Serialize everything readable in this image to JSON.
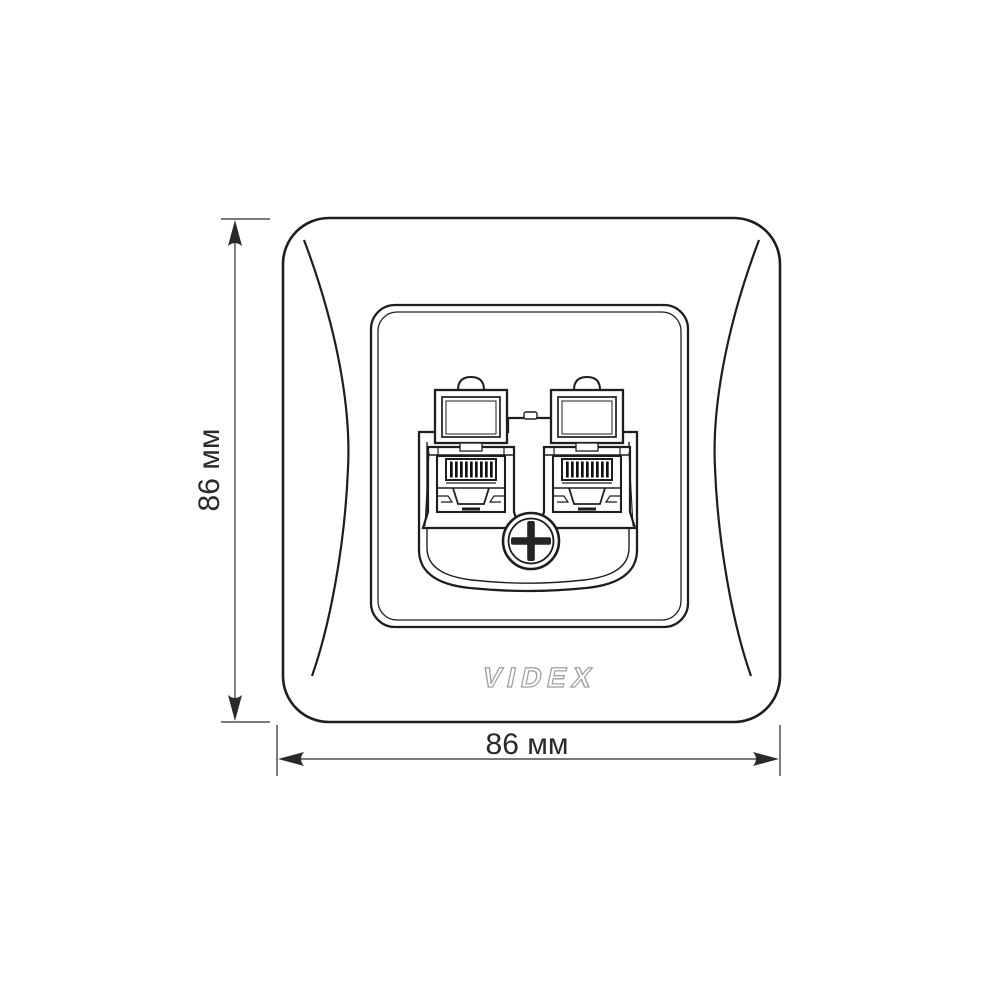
{
  "drawing": {
    "brand_logo": "VIDEX",
    "subject": "double-rj45-wall-socket-faceplate",
    "ports": 2,
    "colors": {
      "line": "#1e1e1e",
      "dimension_line": "#4f4f4f",
      "tick": "#7a7a7a",
      "logo_outline": "#a0a0a0",
      "background": "#ffffff"
    }
  },
  "dimensions": {
    "height": {
      "label": "86 мм"
    },
    "width": {
      "label": "86 мм"
    }
  }
}
